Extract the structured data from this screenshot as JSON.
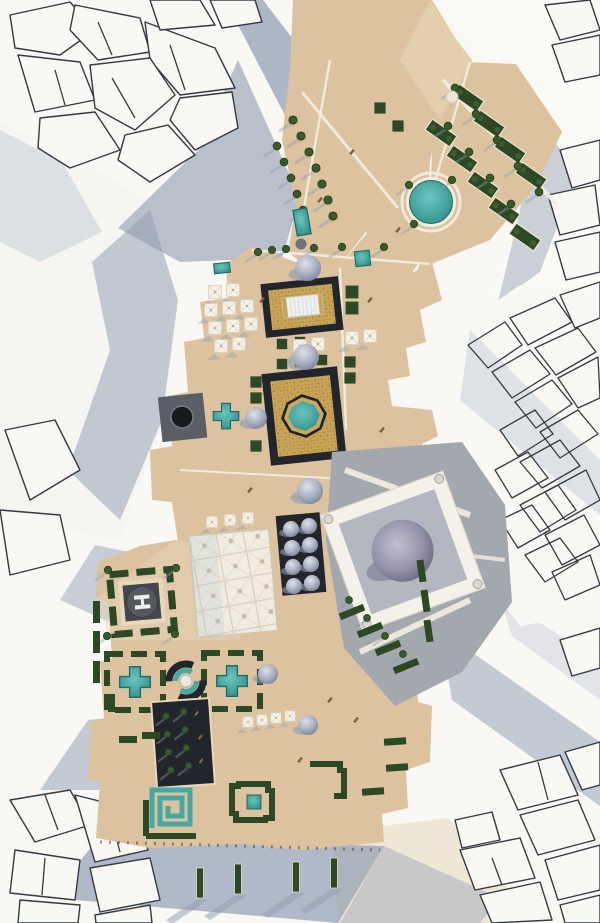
{
  "scene": {
    "title": "Aerial masterplan render",
    "description": "Top-down architectural rendering of a sand-coloured heritage development with courtyards, teal pools, gardens, a grey-domed mosque, a canopy grid and a helipad, surrounded by white city massing blocks casting blue-grey shadows."
  },
  "helipad": {
    "label": "H"
  },
  "symbols": {
    "tree": "tree",
    "umb": "umbrella-canopy",
    "dome": "dome-roof",
    "hs": "hedge-planter",
    "bed": "garden-bed",
    "bench": "bench",
    "cross": "cross-shaped-pool"
  },
  "colors": {
    "sand": "#dcc29e",
    "sandLight": "#e9d8ba",
    "cream": "#efe7d6",
    "path": "#f4eee2",
    "white": "#f9f8f5",
    "outline": "#353a41",
    "shadow": "#8d9bb1",
    "shadowLight": "#b6c0d0",
    "teal": "#44a9a3",
    "tealDeep": "#257f7a",
    "greenDark": "#26401f",
    "hedge": "#2c4824",
    "gold": "#c8a557",
    "goldLine": "#ae8b40",
    "goldDark": "#6f5620",
    "grayPlaza": "#a3a7ae",
    "darkCourt": "#22252b",
    "helideck": "#44484d",
    "helicircle": "#55595f",
    "bench": "#7e5f40"
  }
}
